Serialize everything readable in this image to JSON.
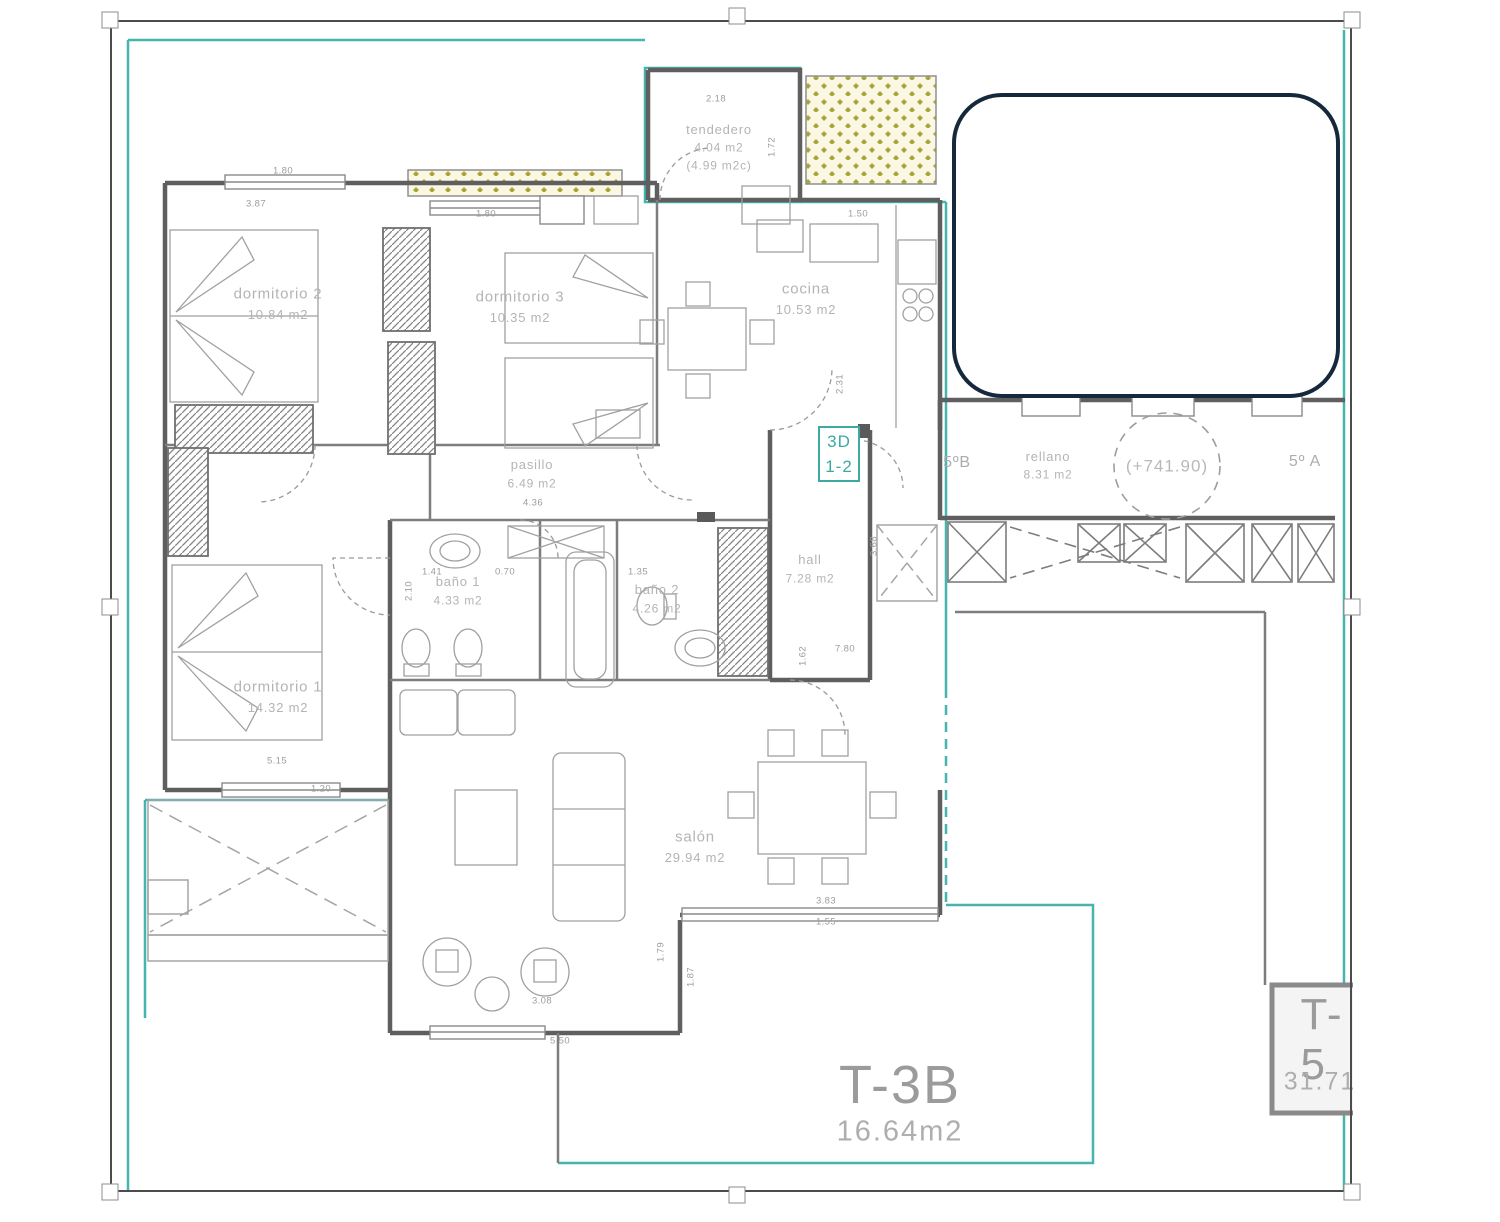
{
  "plan": {
    "rooms": {
      "dormitorio2": {
        "name": "dormitorio 2",
        "area": "10.84 m2"
      },
      "dormitorio3": {
        "name": "dormitorio 3",
        "area": "10.35 m2"
      },
      "tendedero": {
        "name": "tendedero",
        "area": "4.04 m2",
        "area2": "(4.99 m2c)"
      },
      "cocina": {
        "name": "cocina",
        "area": "10.53 m2"
      },
      "pasillo": {
        "name": "pasillo",
        "area": "6.49 m2"
      },
      "hall": {
        "name": "hall",
        "area": "7.28 m2"
      },
      "bano1": {
        "name": "baño 1",
        "area": "4.33 m2"
      },
      "bano2": {
        "name": "baño 2",
        "area": "4.26 m2"
      },
      "dormitorio1": {
        "name": "dormitorio 1",
        "area": "14.32 m2"
      },
      "salon": {
        "name": "salón",
        "area": "29.94 m2"
      },
      "rellano": {
        "name": "rellano",
        "area": "8.31 m2"
      }
    },
    "units": {
      "left": "5ºB",
      "right": "5º A"
    },
    "level_mark": "(+741.90)",
    "ref_box": {
      "line1": "3D",
      "line2": "1-2"
    },
    "terraces": {
      "t3b": {
        "code": "T-3B",
        "area": "16.64m2"
      },
      "t5": {
        "code": "T-5",
        "area": "31.71"
      }
    },
    "dimensions": [
      "1.80",
      "3.87",
      "1.80",
      "2.18",
      "1.72",
      "1.50",
      "2.31",
      "4.36",
      "0.70",
      "1.41",
      "1.35",
      "7.80",
      "5.15",
      "1.20",
      "3.83",
      "1.55",
      "1.79",
      "1.87",
      "5.50",
      "2.10",
      "3.08",
      "1.62",
      "3.68"
    ]
  },
  "colors": {
    "teal_boundary": "#45b5ae",
    "wall_gray": "#6a6a6a",
    "label_gray": "#b4b4b4",
    "redaction_border": "#16293c",
    "hatch_yellow": "#a9a53b"
  }
}
